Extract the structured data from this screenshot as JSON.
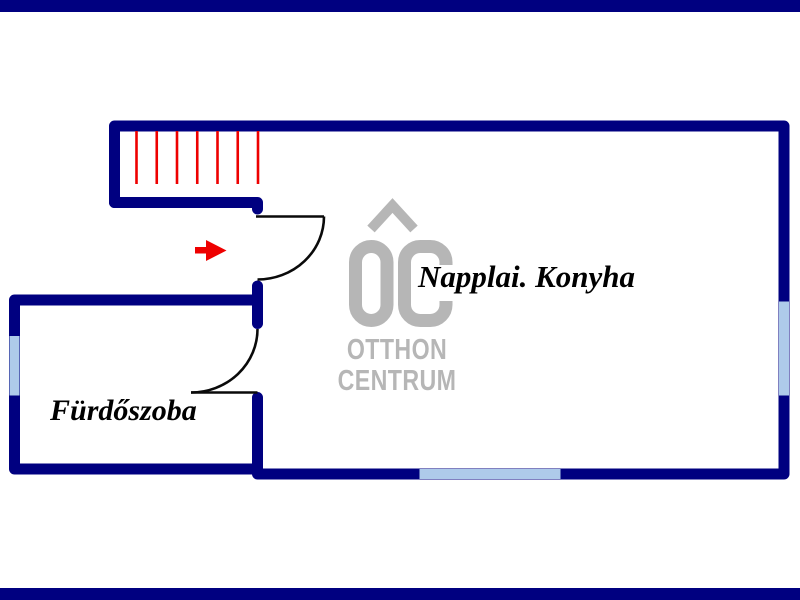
{
  "document": {
    "type": "floor-plan",
    "language": "Hungarian"
  },
  "rooms": {
    "living_kitchen": {
      "label": "Napplai. Konyha"
    },
    "bathroom": {
      "label": "Fürdőszoba"
    }
  },
  "watermark": {
    "logo": "OC house logo",
    "line1": "OTTHON",
    "line2": "CENTRUM"
  },
  "features": {
    "stairs": {
      "treads": 7,
      "location": "top-left"
    },
    "entry_arrow": {
      "direction": "right"
    },
    "doors": 2,
    "windows": 3
  },
  "colors": {
    "wall_navy": "#000080",
    "window_blue": "#aecbea",
    "stair_red": "#ee0000",
    "watermark_gray": "#b6b6b6",
    "label_black": "#000000"
  }
}
